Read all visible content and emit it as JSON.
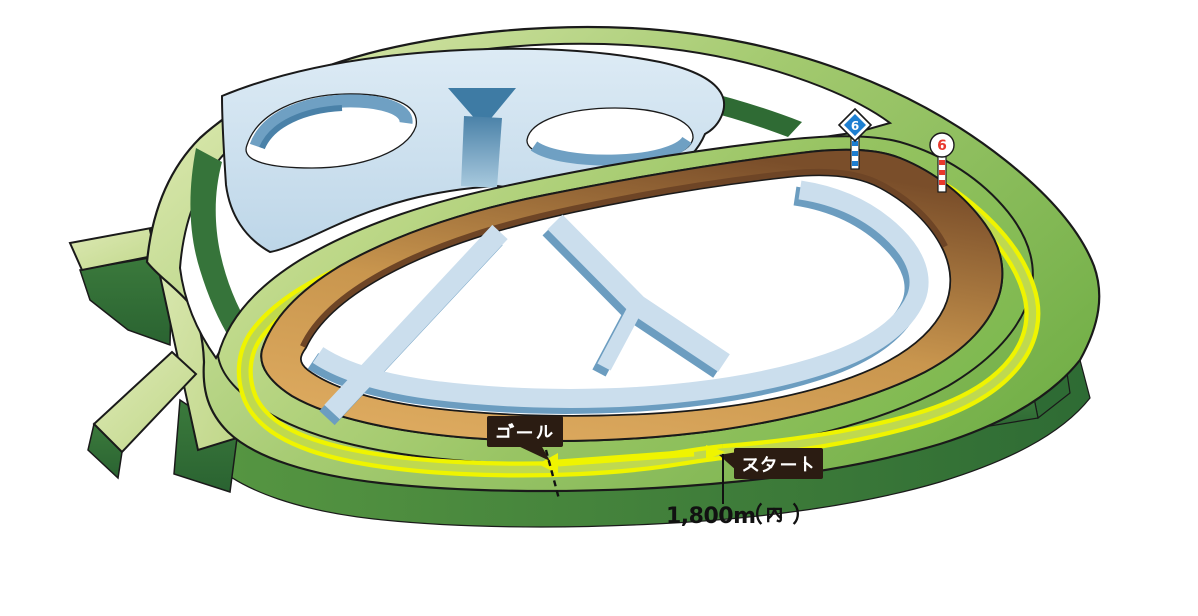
{
  "course_map": {
    "goal_label": "ゴール",
    "start_label": "スタート",
    "distance_label": "1,800m（内）",
    "distance_latin": "1,800m",
    "distance_suffix": "（内）",
    "markers": {
      "diamond_post": {
        "value": "6",
        "shape": "diamond",
        "sign_color": "#1e7fd1",
        "pole": "blue-white-striped"
      },
      "circle_post": {
        "value": "6",
        "shape": "circle",
        "sign_color": "#e8382d",
        "pole": "red-white-striped"
      }
    },
    "race_direction_arrow": "left",
    "colors": {
      "outline": "#1a1a1a",
      "turf_pale": "#d6e5a6",
      "turf_green": "#7cb84e",
      "turf_side_dark": "#2e6b34",
      "course_highlight_yellow": "#eff400",
      "lane_center_green": "#bfd94f",
      "dirt_light": "#dca95e",
      "dirt_dark": "#7a4e2a",
      "jump_course_light": "#cbdeed",
      "jump_course_mid": "#6c9dc0",
      "infield": "#ffffff",
      "label_background": "#2b1c12",
      "label_text": "#ffffff"
    }
  }
}
